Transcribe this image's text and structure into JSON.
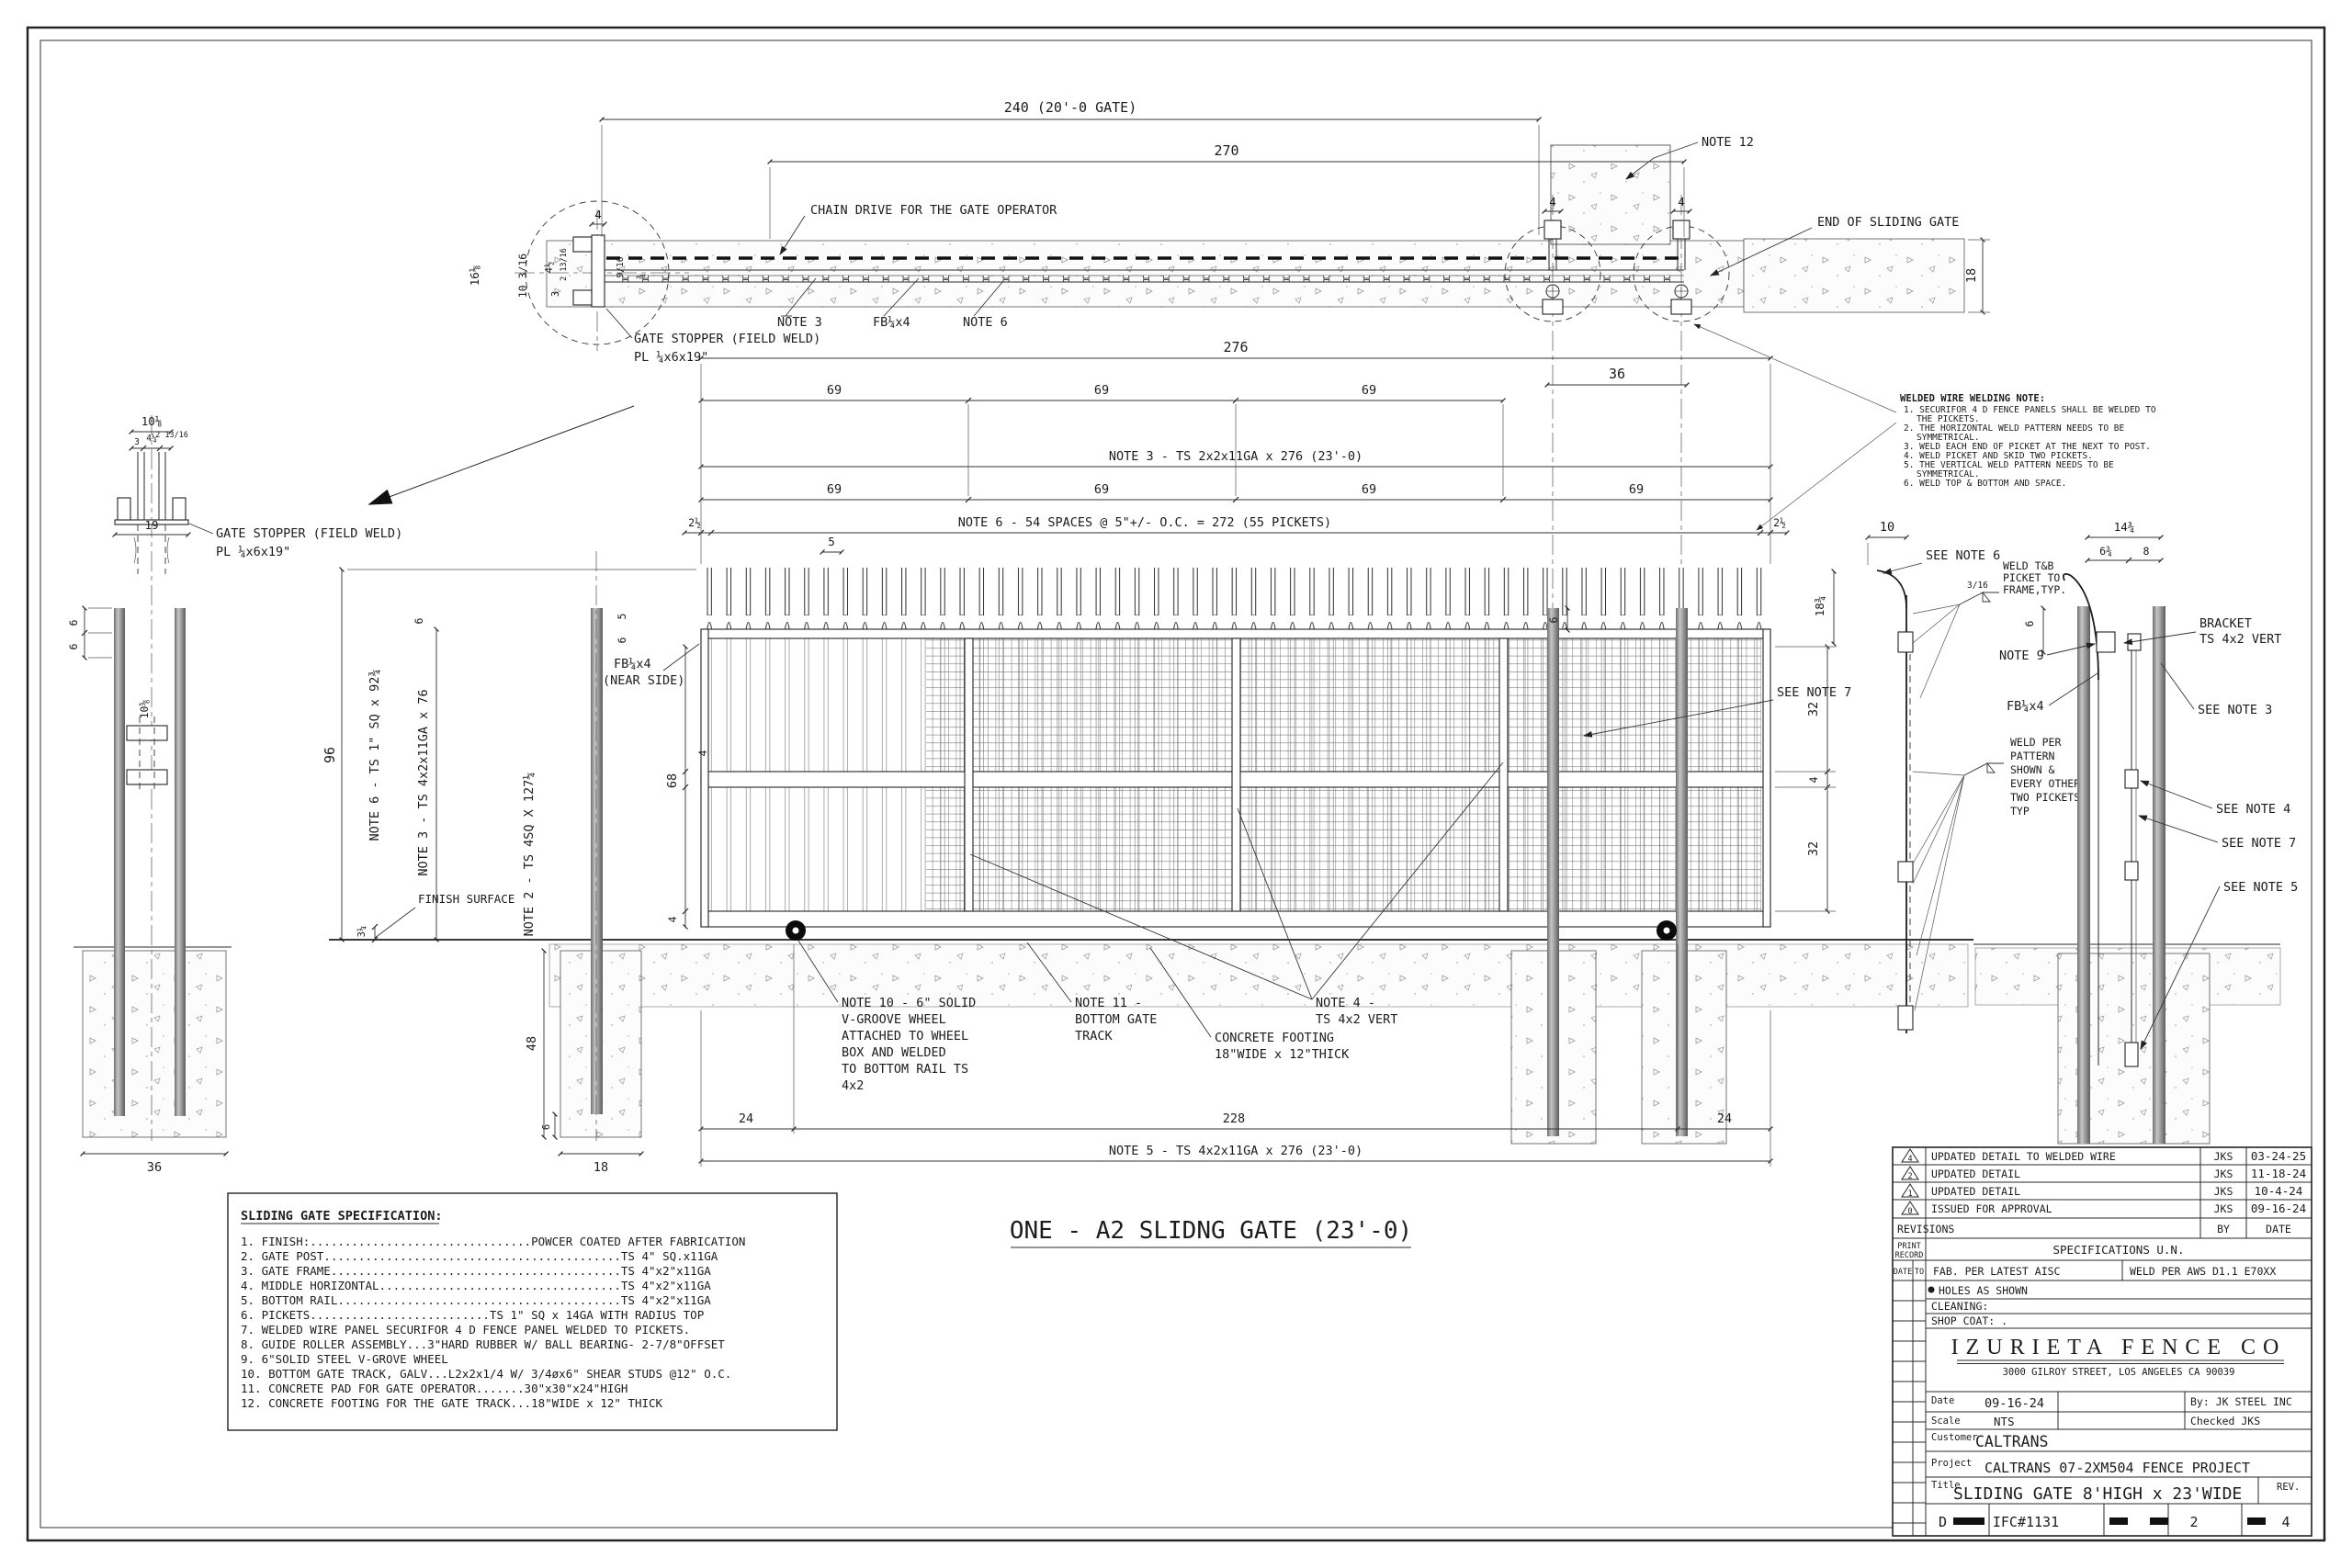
{
  "sheet": {
    "plan": {
      "dim_240": "240 (20'-0 GATE)",
      "dim_270": "270",
      "chain_drive": "CHAIN DRIVE FOR THE GATE OPERATOR",
      "note_12": "NOTE 12",
      "end_of_sliding_gate": "END OF SLIDING GATE",
      "dim_18": "18",
      "dim_4": "4",
      "note_3": "NOTE 3",
      "fb_quarter_x4": "FB¼x4",
      "note_6": "NOTE 6",
      "gate_stopper_line1": "GATE STOPPER (FIELD WELD)",
      "gate_stopper_line2": "PL ¼x6x19\"",
      "dim_16_1_8": "16⅛",
      "dim_10_3_16": "10 3/16",
      "dim_4_1_2": "4½",
      "dim_2_13_16": "2 13/16",
      "dim_3": "3",
      "dim_9_16": "9/16",
      "dim_3_4": "¾"
    },
    "gate_dims": {
      "dim_276": "276",
      "dim_36": "36",
      "dim_69": "69",
      "note3_member": "NOTE 3 - TS 2x2x11GA x 276 (23'-0)",
      "dim_2_1_2": "2½",
      "note6_spacing": "NOTE 6 - 54 SPACES @ 5\"+/- O.C. = 272 (55 PICKETS)",
      "dim_5": "5"
    },
    "stopper_detail": {
      "dim_10_1_8": "10⅛",
      "dim_4_1_4": "4¼",
      "dim_2_13_16": "2 13/16",
      "dim_3": "3",
      "dim_19": "19",
      "dim_6": "6",
      "dim_10_5_8": "10⅝",
      "dim_36": "36"
    },
    "elevation": {
      "dim_96": "96",
      "note6_picket": "NOTE 6 - TS 1\" SQ x 92¾",
      "note3_frame": "NOTE 3 - TS 4x2x11GA x 76",
      "note2_post": "NOTE 2 - TS 4SQ X 127¼",
      "finish_surface": "FINISH S&#8203;URFACE",
      "finish_surface_text": "FINISH SURFACE",
      "dim_3_1_4": "3¼",
      "dim_48": "48",
      "dim_18": "18",
      "dim_6": "6",
      "dim_5": "5",
      "fb_line1": "FB¼x4",
      "fb_line2": "(NEAR SIDE)",
      "dim_68": "68",
      "dim_4": "4",
      "dim_32": "32",
      "see_note_7": "SEE NOTE 7",
      "dim_24": "24",
      "dim_228": "228",
      "note5_member": "NOTE 5 - TS 4x2x11GA x 276 (23'-0)",
      "note10": [
        "NOTE 10 - 6\" SOLID",
        "V-GROOVE WHEEL",
        "ATTACHED TO WHEEL",
        "BOX AND WELDED",
        "TO BOTTOM RAIL TS",
        "4x2"
      ],
      "note11": [
        "NOTE 11 -",
        "BOTTOM GATE",
        "TRACK"
      ],
      "footing_note": [
        "CONCRETE FOOTING",
        "18\"WIDE x 12\"THICK"
      ],
      "note4": [
        "NOTE 4 -",
        "TS 4x2 VERT"
      ]
    },
    "right_details": {
      "dim_10": "10",
      "see_note_6": "SEE NOTE 6",
      "weld_3_16": "3/16",
      "weld_tb": [
        "WELD T&B",
        "PICKET TO",
        "FRAME,TYP."
      ],
      "dim_18_3_4": "18¾",
      "dim_14_3_4": "14¾",
      "dim_6_3_4": "6¾",
      "dim_8": "8",
      "dim_6": "6",
      "note_9": "NOTE 9",
      "bracket": [
        "BRACKET",
        "TS 4x2 VERT"
      ],
      "fb": "FB¼x4",
      "see_note_3": "SEE NOTE 3",
      "weld_pattern": [
        "WELD PER",
        "PATTERN",
        "SHOWN &",
        "EVERY OTHER",
        "TWO PICKETS,",
        "TYP"
      ],
      "see_note_4": "SEE NOTE 4",
      "see_note_7": "SEE NOTE 7",
      "see_note_5": "SEE NOTE 5"
    },
    "welding_note": {
      "title": "WELDED WIRE WELDING NOTE:",
      "lines": [
        "1. SECURIFOR 4 D FENCE PANELS SHALL BE WELDED TO",
        "THE PICKETS.",
        "2. THE HORIZONTAL WELD PATTERN NEEDS TO BE",
        "SYMMETRICAL.",
        "3. WELD EACH END OF PICKET AT THE NEXT TO POST.",
        "4. WELD PICKET AND SKID TWO PICKETS.",
        "5. THE VERTICAL WELD PATTERN NEEDS TO BE",
        "SYMMETRICAL.",
        "6. WELD TOP & BOTTOM AND SPACE."
      ]
    },
    "specification": {
      "title": "SLIDING GATE SPECIFICATION:",
      "items": [
        "1. FINISH:................................POWCER COATED AFTER FABRICATION",
        "2. GATE POST...........................................TS 4\" SQ.x11GA",
        "3. GATE FRAME..........................................TS 4\"x2\"x11GA",
        "4. MIDDLE HORIZONTAL...................................TS 4\"x2\"x11GA",
        "5. BOTTOM RAIL.........................................TS 4\"x2\"x11GA",
        "6. PICKETS..........................TS 1\" SQ x 14GA WITH RADIUS TOP",
        "7. WELDED WIRE PANEL SECURIFOR 4 D FENCE PANEL WELDED TO PICKETS.",
        "8. GUIDE ROLLER ASSEMBLY...3\"HARD RUBBER W/ BALL BEARING- 2-7/8\"OFFSET",
        "9. 6\"SOLID STEEL V-GROVE WHEEL",
        "10. BOTTOM GATE TRACK, GALV...L2x2x1/4 W/ 3/4øx6\" SHEAR STUDS @12\" O.C.",
        "11. CONCRETE PAD FOR GATE OPERATOR.......30\"x30\"x24\"HIGH",
        "12. CONCRETE FOOTING FOR THE GATE TRACK...18\"WIDE x 12\" THICK"
      ]
    },
    "caption": "ONE - A2 SLIDNG GATE (23'-0)",
    "title_block": {
      "revisions": [
        {
          "sym": "4",
          "desc": "UPDATED DETAIL TO WELDED WIRE",
          "by": "JKS",
          "date": "03-24-25"
        },
        {
          "sym": "2",
          "desc": "UPDATED DETAIL",
          "by": "JKS",
          "date": "11-18-24"
        },
        {
          "sym": "1",
          "desc": "UPDATED DETAIL",
          "by": "JKS",
          "date": "10-4-24"
        },
        {
          "sym": "0",
          "desc": "ISSUED FOR APPROVAL",
          "by": "JKS",
          "date": "09-16-24"
        }
      ],
      "revisions_label": "REVISIONS",
      "by_label": "BY",
      "date_label": "DATE",
      "print_label1": "PRINT",
      "print_label2": "RECORD",
      "spec_heading": "SPECIFICATIONS  U.N.",
      "col_date": "DATE",
      "col_to": "TO",
      "fab_note": "FAB. PER LATEST AISC",
      "weld_note": "WELD PER AWS D1.1 E70XX",
      "holes_note": "HOLES AS SHOWN",
      "cleaning_label": "CLEANING:",
      "shop_coat_label": "SHOP COAT: .",
      "company": "IZURIETA FENCE CO",
      "address": "3000 GILROY STREET, LOS ANGELES CA 90039",
      "date_label2": "Date",
      "date_value": "09-16-24",
      "by_value": "By: JK STEEL INC",
      "scale_label": "Scale",
      "scale_value": "NTS",
      "checked_value": "Checked JKS",
      "customer_label": "Customer",
      "customer_value": "CALTRANS",
      "project_label": "Project",
      "project_value": "CALTRANS 07-2XM504 FENCE PROJECT",
      "title_label": "Title",
      "title_value": "SLIDING GATE 8'HIGH x 23'WIDE",
      "rev_label": "REV.",
      "sheet_letter": "D",
      "drawing_no": "IFC#1131",
      "sheet_no": "2",
      "sheet_total": "4"
    }
  }
}
